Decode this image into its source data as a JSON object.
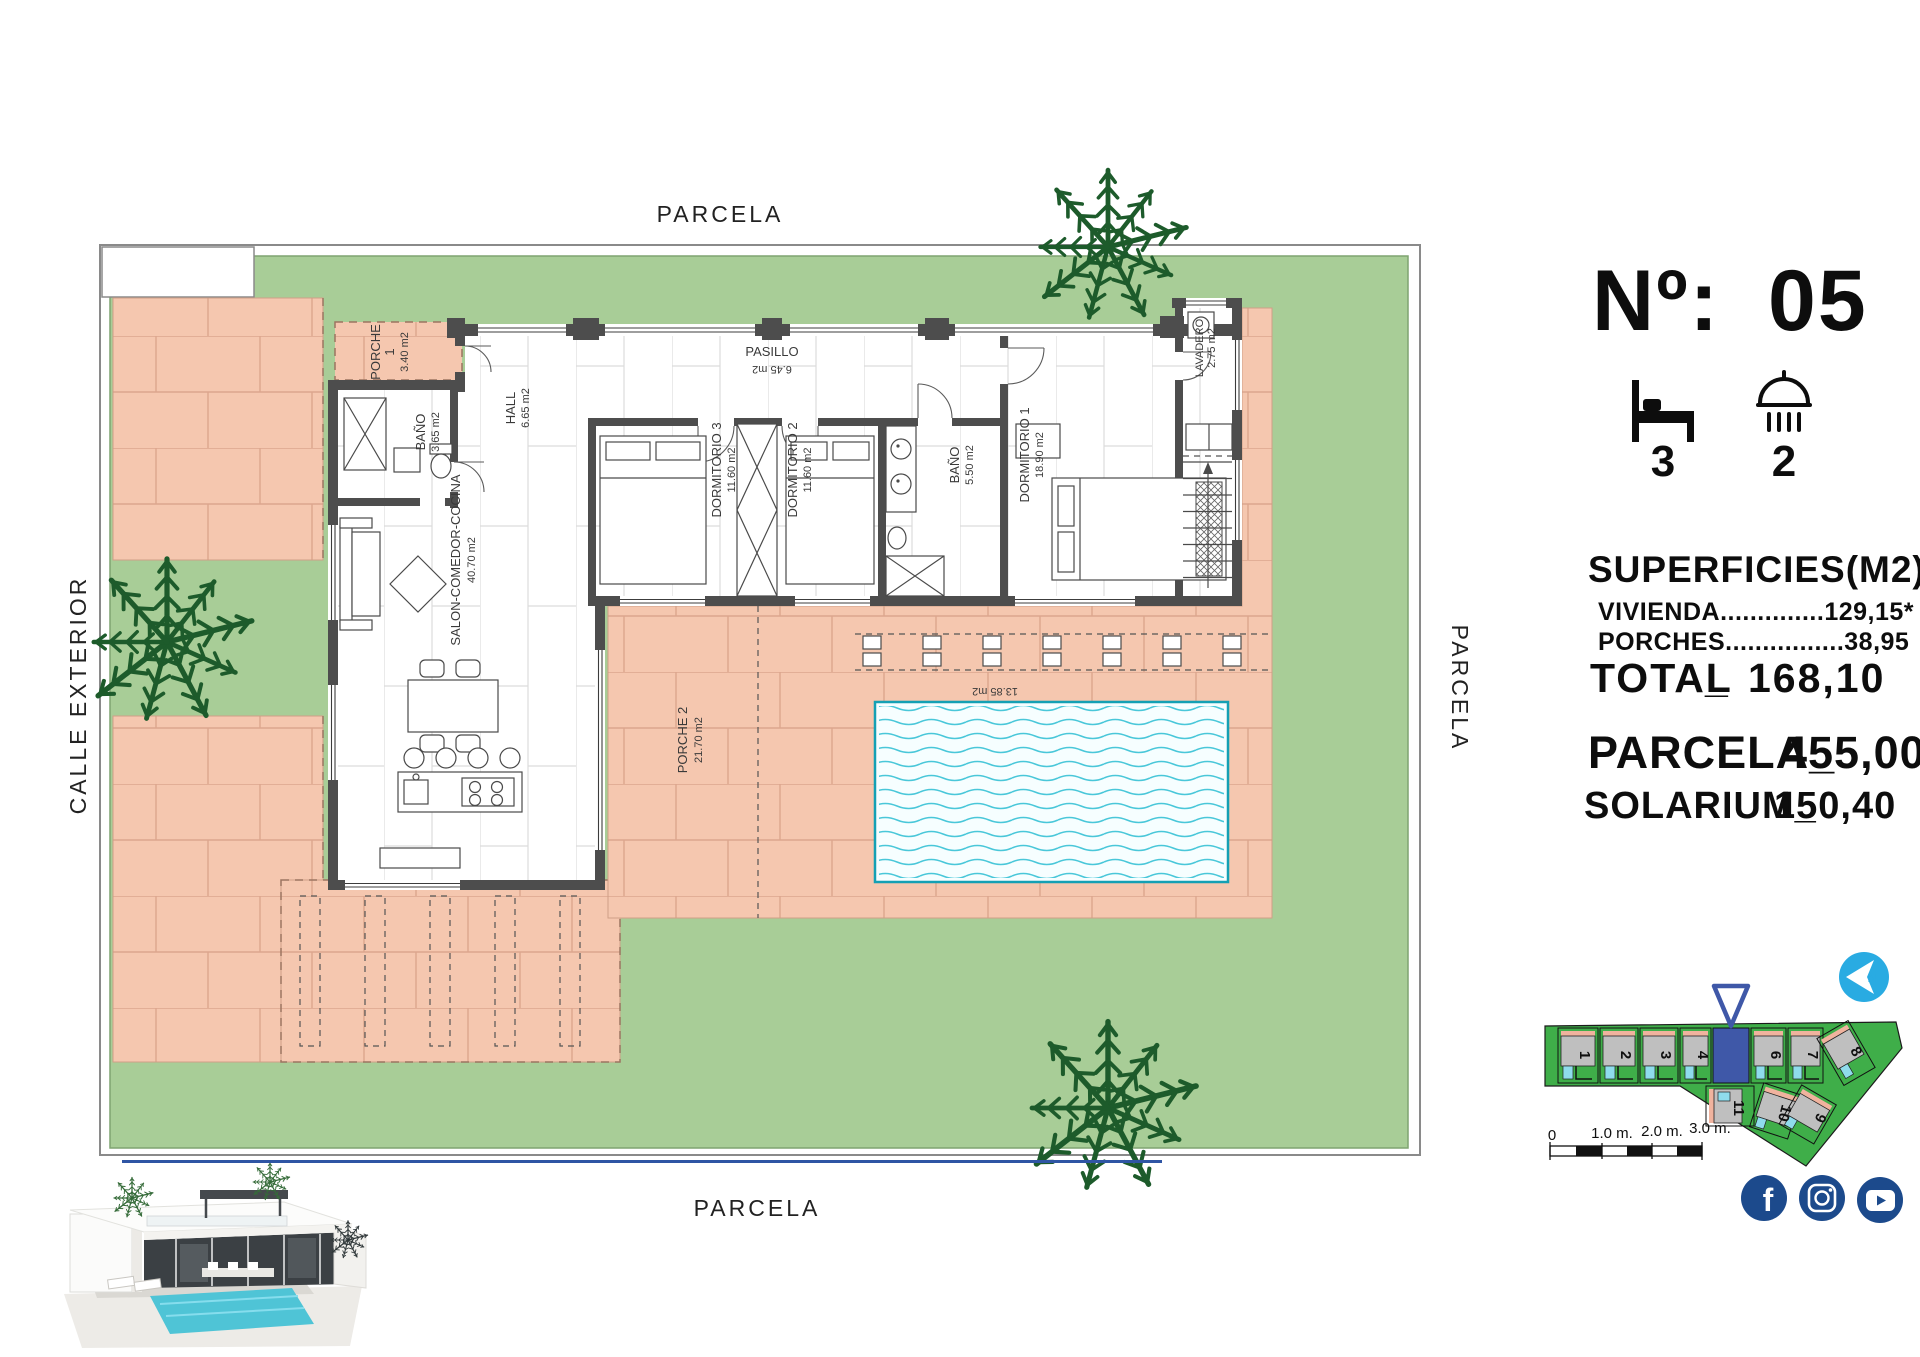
{
  "title_block": {
    "number_label": "Nº:",
    "number_value": "05",
    "bedrooms": "3",
    "bathrooms": "2"
  },
  "surfaces": {
    "title": "SUPERFICIES(M2)",
    "vivienda": "VIVIENDA..............129,15*",
    "porches": "PORCHES................38,95",
    "total_label": "TOTAL",
    "total_sep": "_",
    "total_value": "168,10",
    "parcela_label": "PARCELA_",
    "parcela_value": "455,00",
    "solarium_label": "SOLARIUM_",
    "solarium_value": "150,40"
  },
  "plot_labels": {
    "top": "PARCELA",
    "bottom": "PARCELA",
    "right": "PARCELA",
    "left": "CALLE EXTERIOR"
  },
  "rooms": {
    "porche1": {
      "name": "PORCHE",
      "number": "1",
      "area": "3.40 m2"
    },
    "bano1": {
      "name": "BAÑO",
      "area": "3.65 m2"
    },
    "hall": {
      "name": "HALL",
      "area": "6.65 m2"
    },
    "pasillo": {
      "name": "PASILLO",
      "area": "6.45 m2"
    },
    "dormitorio3": {
      "name": "DORMITORIO 3",
      "area": "11.60 m2"
    },
    "dormitorio2": {
      "name": "DORMITORIO 2",
      "area": "11.60 m2"
    },
    "bano2": {
      "name": "BAÑO",
      "area": "5.50 m2"
    },
    "dormitorio1": {
      "name": "DORMITORIO 1",
      "area": "18.90 m2"
    },
    "lavadero": {
      "name": "LAVADERO",
      "area": "2.75 m2"
    },
    "salon": {
      "name": "SALON-COMEDOR-COCINA",
      "area": "40.70 m2"
    },
    "porche2": {
      "name": "PORCHE 2",
      "area": "21.70 m2"
    },
    "porche3_dim": "13.85 m2"
  },
  "site_plan": {
    "plots": [
      "1",
      "2",
      "3",
      "4",
      "6",
      "7",
      "8",
      "9",
      "10",
      "11"
    ],
    "compass_letter": "N",
    "scale": [
      "0",
      "1.0 m.",
      "2.0 m.",
      "3.0 m."
    ]
  },
  "social": {
    "facebook": "facebook",
    "instagram": "instagram",
    "youtube": "youtube"
  },
  "colors": {
    "lawn": "#a8cd97",
    "tile": "#f5c7af",
    "wall": "#4d4d4d",
    "pool_line": "#49c7d9",
    "site_green": "#3fae49",
    "accent_blue": "#3f58a8",
    "social_blue": "#1c4a8c",
    "compass_blue": "#29abe2"
  }
}
